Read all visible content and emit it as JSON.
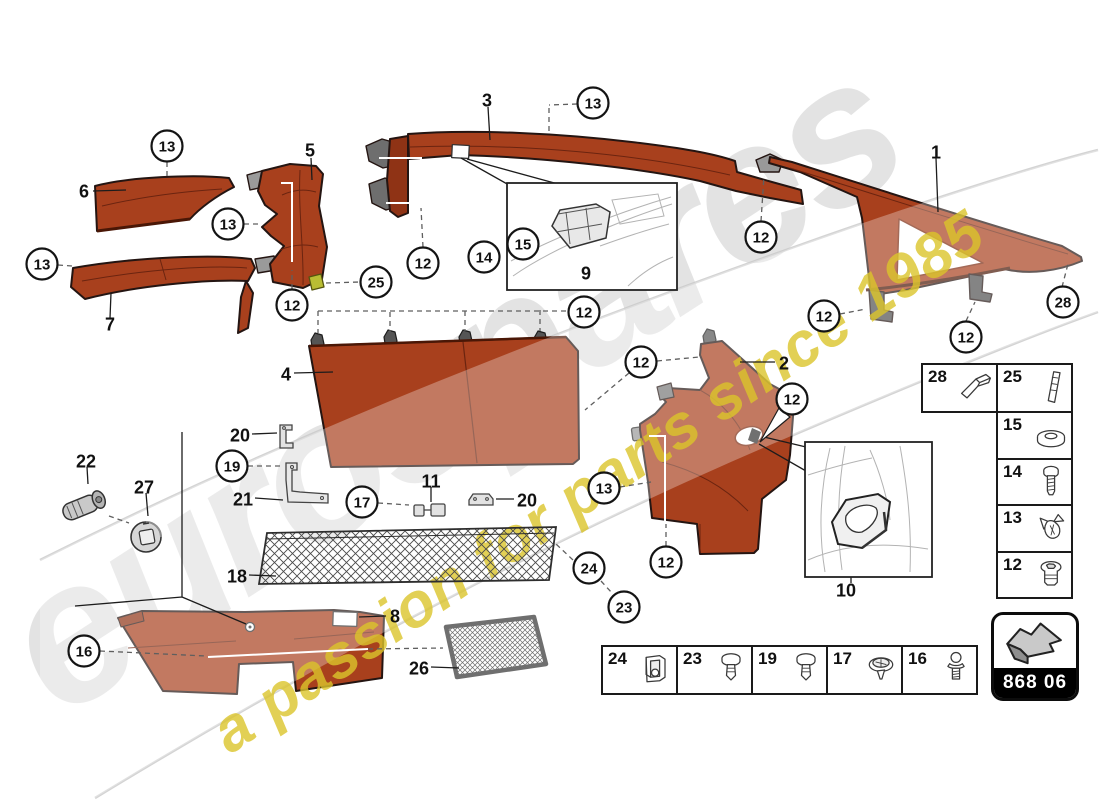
{
  "watermark": {
    "brand": "eurospares",
    "tagline": "a passion for parts since 1985"
  },
  "code_badge": {
    "code": "868 06",
    "icon": "direction-arrow"
  },
  "colors": {
    "part_red": "#a8401d",
    "part_red_dark": "#7c2a10",
    "outline": "#241512",
    "clip_gray": "#9a9a9a",
    "highlight_clip_yellow": "#b9bd33",
    "watermark_gray": "#c9c9c9",
    "watermark_yellow": "#dcc52b"
  },
  "callouts": [
    {
      "n": "13",
      "x": 167,
      "y": 146
    },
    {
      "n": "13",
      "x": 228,
      "y": 224
    },
    {
      "n": "13",
      "x": 42,
      "y": 264
    },
    {
      "n": "12",
      "x": 292,
      "y": 305
    },
    {
      "n": "25",
      "x": 376,
      "y": 282
    },
    {
      "n": "13",
      "x": 593,
      "y": 103
    },
    {
      "n": "12",
      "x": 423,
      "y": 263
    },
    {
      "n": "14",
      "x": 484,
      "y": 257
    },
    {
      "n": "15",
      "x": 523,
      "y": 244
    },
    {
      "n": "12",
      "x": 584,
      "y": 312
    },
    {
      "n": "12",
      "x": 761,
      "y": 237
    },
    {
      "n": "12",
      "x": 824,
      "y": 316
    },
    {
      "n": "12",
      "x": 966,
      "y": 337
    },
    {
      "n": "28",
      "x": 1063,
      "y": 302
    },
    {
      "n": "12",
      "x": 641,
      "y": 362
    },
    {
      "n": "12",
      "x": 792,
      "y": 399
    },
    {
      "n": "13",
      "x": 604,
      "y": 488
    },
    {
      "n": "12",
      "x": 666,
      "y": 562
    },
    {
      "n": "17",
      "x": 362,
      "y": 502
    },
    {
      "n": "19",
      "x": 232,
      "y": 466
    },
    {
      "n": "16",
      "x": 84,
      "y": 651
    },
    {
      "n": "24",
      "x": 589,
      "y": 568
    },
    {
      "n": "23",
      "x": 624,
      "y": 607
    }
  ],
  "part_labels": [
    {
      "n": "6",
      "x": 84,
      "y": 191
    },
    {
      "n": "5",
      "x": 310,
      "y": 150
    },
    {
      "n": "7",
      "x": 110,
      "y": 324
    },
    {
      "n": "3",
      "x": 487,
      "y": 100
    },
    {
      "n": "1",
      "x": 936,
      "y": 152
    },
    {
      "n": "9",
      "x": 586,
      "y": 273
    },
    {
      "n": "2",
      "x": 784,
      "y": 363
    },
    {
      "n": "4",
      "x": 286,
      "y": 374
    },
    {
      "n": "20",
      "x": 240,
      "y": 435
    },
    {
      "n": "21",
      "x": 243,
      "y": 499
    },
    {
      "n": "11",
      "x": 431,
      "y": 481
    },
    {
      "n": "20",
      "x": 527,
      "y": 500
    },
    {
      "n": "18",
      "x": 237,
      "y": 576
    },
    {
      "n": "8",
      "x": 395,
      "y": 616
    },
    {
      "n": "26",
      "x": 419,
      "y": 668
    },
    {
      "n": "10",
      "x": 846,
      "y": 590
    },
    {
      "n": "22",
      "x": 86,
      "y": 461
    },
    {
      "n": "27",
      "x": 144,
      "y": 487
    }
  ],
  "legend_right": {
    "items": [
      {
        "number": "28",
        "icon": "wedge-strip"
      },
      {
        "number": "25",
        "icon": "trim-strip"
      },
      {
        "number": "15",
        "icon": "washer"
      },
      {
        "number": "14",
        "icon": "screw"
      },
      {
        "number": "13",
        "icon": "spring-clip"
      },
      {
        "number": "12",
        "icon": "grommet-nut"
      }
    ]
  },
  "legend_bottom": {
    "items": [
      {
        "number": "24",
        "icon": "clamp"
      },
      {
        "number": "23",
        "icon": "push-rivet"
      },
      {
        "number": "19",
        "icon": "push-rivet"
      },
      {
        "number": "17",
        "icon": "washer-screw"
      },
      {
        "number": "16",
        "icon": "ball-stud"
      }
    ]
  }
}
